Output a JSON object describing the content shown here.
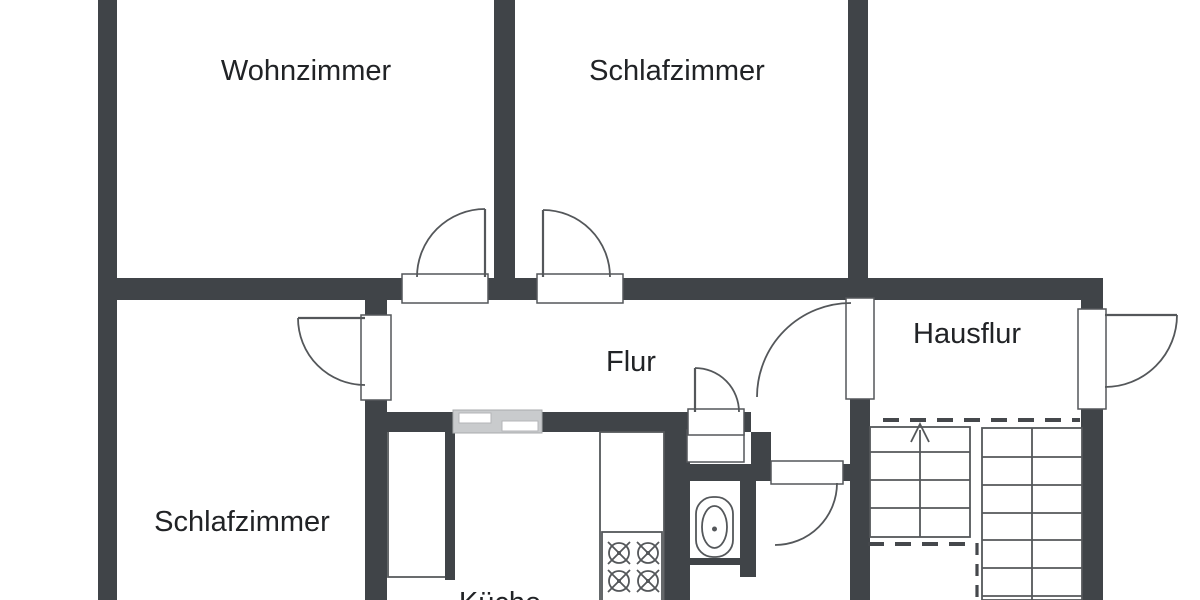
{
  "rooms": {
    "wohnzimmer": {
      "label": "Wohnzimmer"
    },
    "schlafzimmer_top": {
      "label": "Schlafzimmer"
    },
    "schlafzimmer_bottom": {
      "label": "Schlafzimmer"
    },
    "flur": {
      "label": "Flur"
    },
    "hausflur": {
      "label": "Hausflur"
    },
    "kueche": {
      "label": "Küche"
    }
  },
  "icons": {
    "stove": "stove-burners-icon",
    "toilet": "toilet-icon",
    "stairs": "staircase-up-icon",
    "hatch": "pass-through-window-icon",
    "doors": "door-swing-icon"
  },
  "colors": {
    "wall": "#404448",
    "line": "#54575a",
    "hatch_fill": "#c9cbcd",
    "text": "#212326",
    "background": "#ffffff"
  }
}
